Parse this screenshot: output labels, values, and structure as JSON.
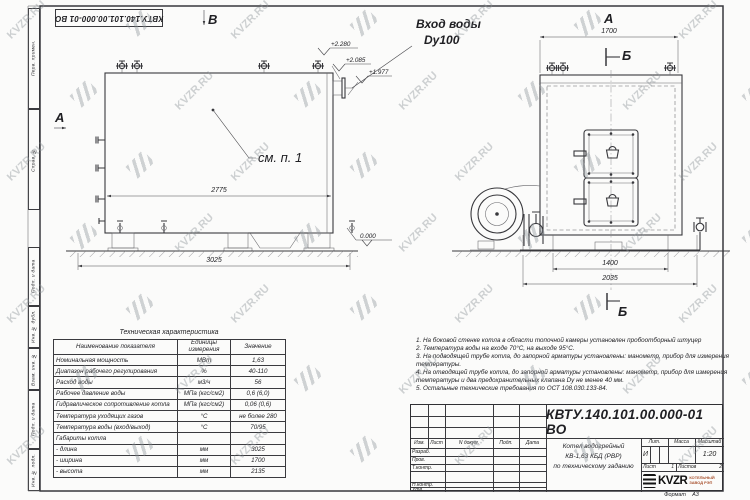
{
  "watermark": {
    "text": "KVZR.RU"
  },
  "frame": {
    "doc_number_top": "КВТУ.140.101.00.000-01 ВО",
    "margin_labels": [
      "Перв. примен.",
      "Справ. №",
      "Подп. и дата",
      "Инв. № дубл.",
      "Взам. инв. №",
      "Подп. и дата",
      "Инв. № подл."
    ],
    "format_label": "Формат",
    "format_value": "А3"
  },
  "front_view": {
    "view_label_top": "В",
    "view_label_left": "А",
    "inlet_line1": "Вход воды",
    "inlet_line2": "Dy100",
    "see_note": "см. п. 1",
    "elevations": [
      "+2.280",
      "+2.085",
      "+1.977",
      "0.000"
    ],
    "dim_inner": "2775",
    "dim_outer": "3025"
  },
  "side_view": {
    "view_label": "А",
    "section_label_top": "Б",
    "section_label_bottom": "Б",
    "dim_top": "1700",
    "dim_inner": "1400",
    "dim_outer": "2035"
  },
  "spec_table": {
    "title": "Техническая характеристика",
    "headers": [
      "Наименование показателя",
      "Единицы измерения",
      "Значение"
    ],
    "rows": [
      [
        "Номинальная мощность",
        "МВт",
        "1,63"
      ],
      [
        "Диапазон рабочего регулирования",
        "%",
        "40-110"
      ],
      [
        "Расход воды",
        "м3/ч",
        "56"
      ],
      [
        "Рабочее давление воды",
        "МПа (кгс/см2)",
        "0,6 (6,0)"
      ],
      [
        "Гидравлическое сопротивление котла",
        "МПа (кгс/см2)",
        "0,06 (0,6)"
      ],
      [
        "Температура уходящих газов",
        "°С",
        "не более 280"
      ],
      [
        "Температура воды (вход/выход)",
        "°С",
        "70/95"
      ],
      [
        "Габариты котла",
        "",
        ""
      ],
      [
        "- длина",
        "мм",
        "3025"
      ],
      [
        "- ширина",
        "мм",
        "1700"
      ],
      [
        "- высота",
        "мм",
        "2135"
      ]
    ]
  },
  "notes": [
    "1. На боковой стенке котла в области топочной камеры установлен пробоотборный штуцер",
    "2. Температура воды на входе 70°С, на выходе 95°С.",
    "3. На подводящей трубе котла, до запорной арматуры установлены: манометр, прибор для измерения температуры.",
    "4. На отводящей трубе котла, до запорной арматуры установлены: манометр, прибор для измерения температуры и два предохранительных клапана Dу не менее 40 мм.",
    "5. Остальные технические требования по ОСТ 108.030.133-84."
  ],
  "title_block": {
    "doc_number": "КВТУ.140.101.00.000-01 ВО",
    "rev_headers": [
      "Изм.",
      "Лист",
      "N докум.",
      "Подп.",
      "Дата"
    ],
    "staff_rows": [
      "Разраб.",
      "Пров.",
      "Т.контр.",
      "Н.контр.",
      "Утв."
    ],
    "title_line1": "Котел водогрейный",
    "title_line2": "КВ-1,63 КБД (РВР)",
    "title_line3": "по техническому заданию",
    "lit_header": "Лит.",
    "mass_header": "Масса",
    "scale_header": "Масштаб",
    "lit_value": "И",
    "mass_value": "",
    "scale_value": "1:20",
    "sheet_label": "Лист",
    "sheet_value": "1",
    "sheets_label": "Листов",
    "sheets_value": "2",
    "company_name": "KVZR",
    "company_sub1": "КОТЕЛЬНЫЙ",
    "company_sub2": "ЗАВОД РЭП"
  }
}
